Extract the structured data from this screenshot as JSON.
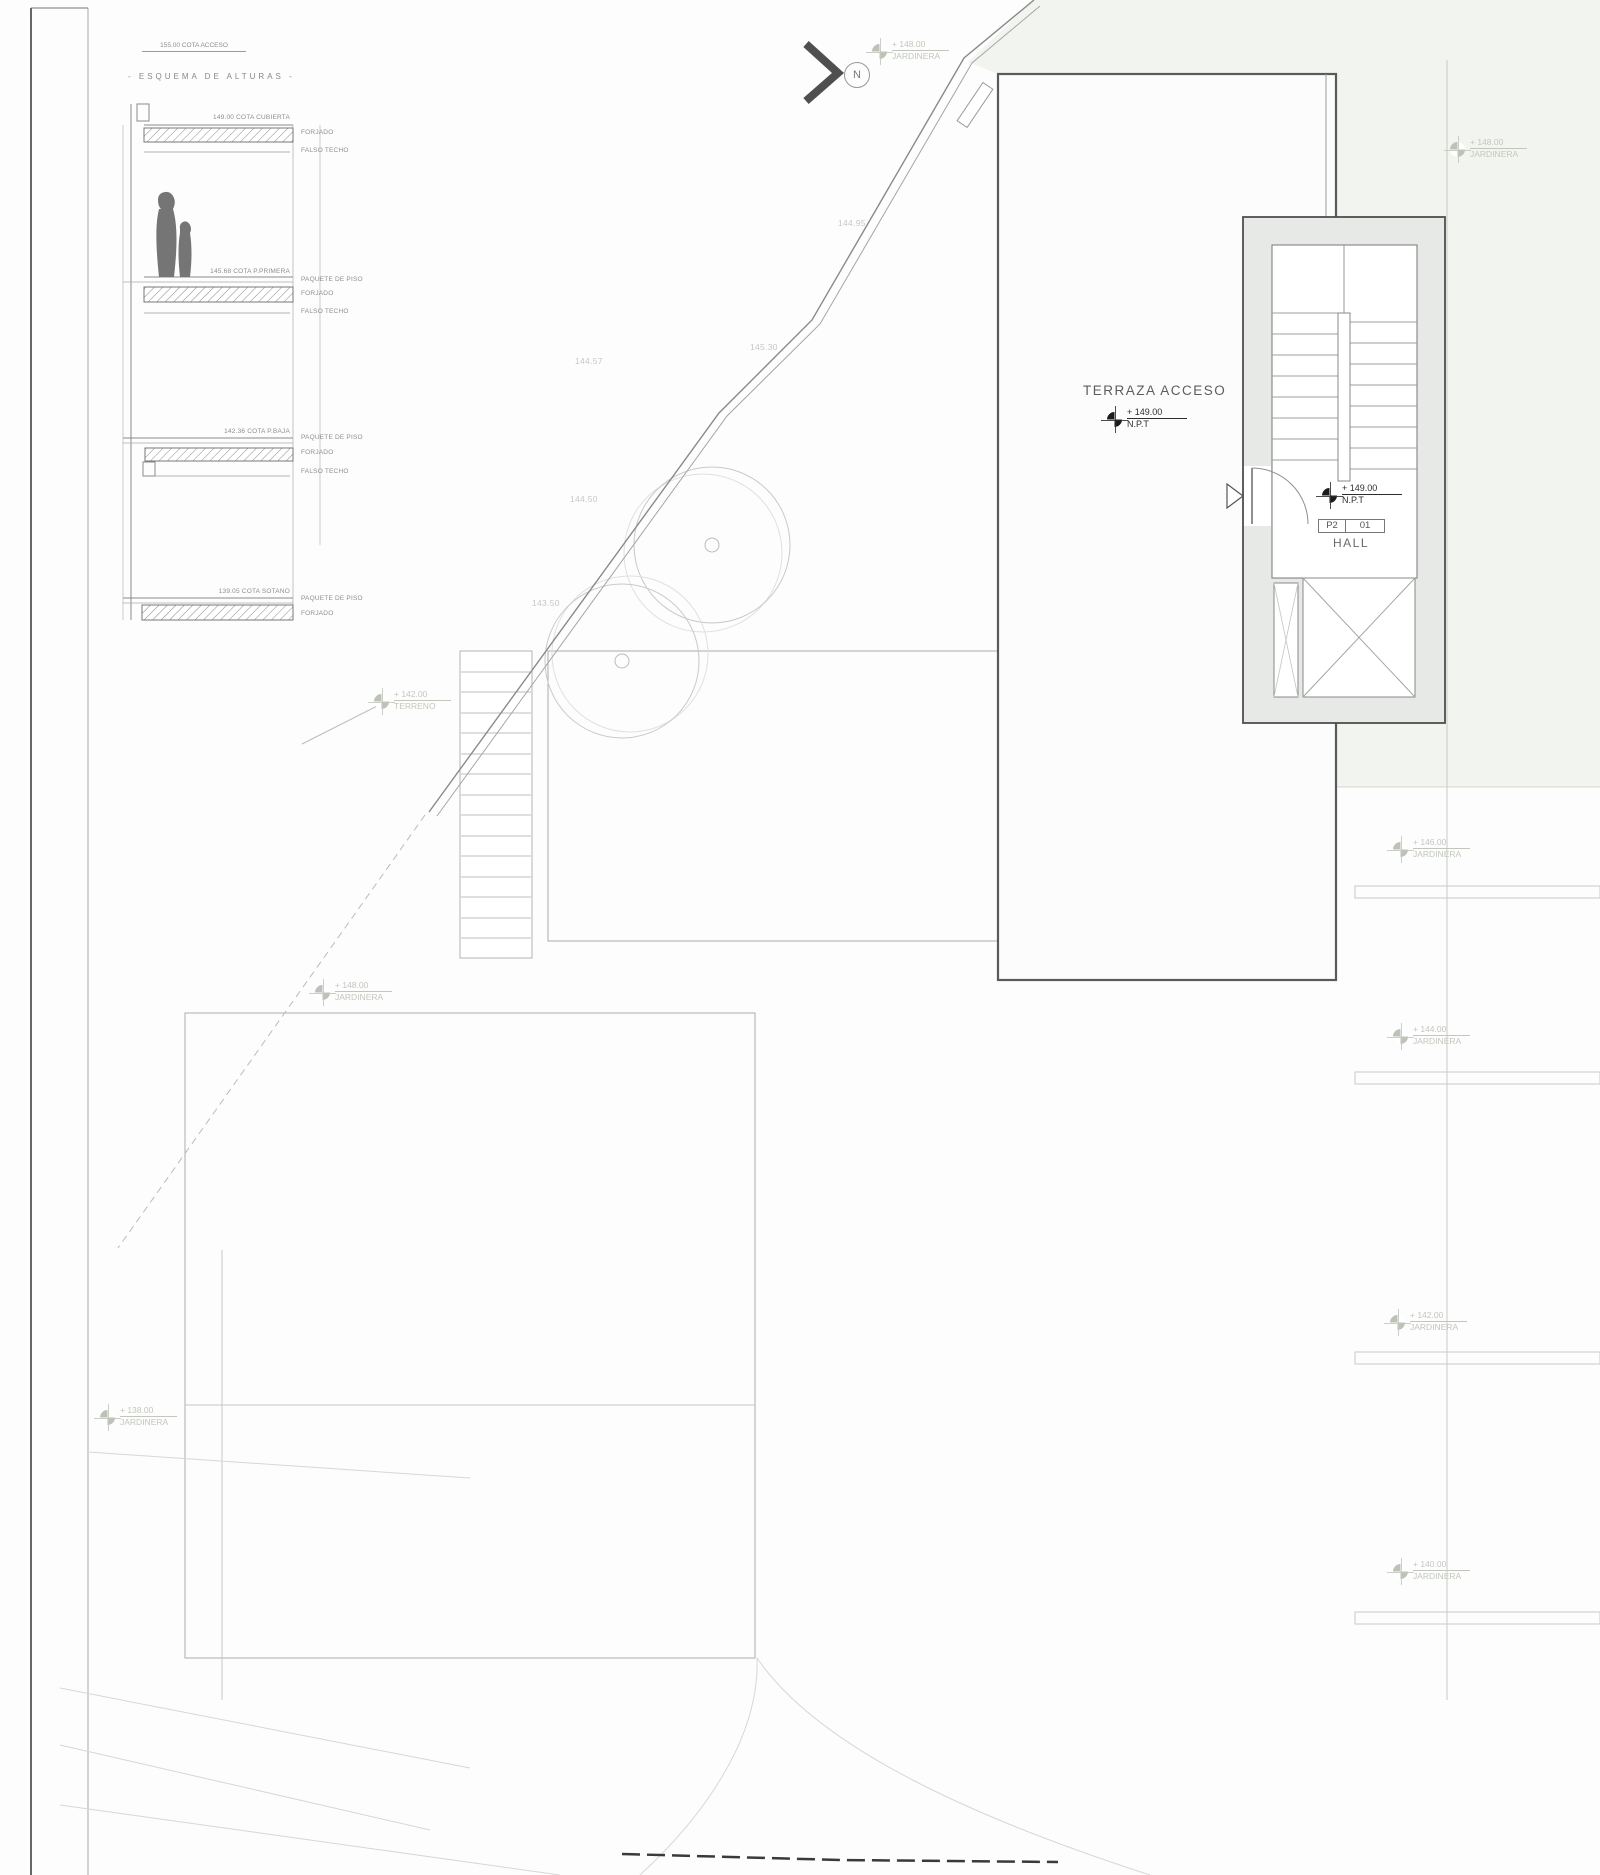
{
  "north": {
    "label": "N"
  },
  "scheme": {
    "access": "155.00 COTA ACCESO",
    "title": "- ESQUEMA DE ALTURAS -",
    "cubierta": "149.00 COTA CUBIERTA",
    "primera": "145.68 COTA P.PRIMERA",
    "baja": "142.36 COTA P.BAJA",
    "sotano": "139.05 COTA SOTANO",
    "forjado": "FORJADO",
    "falso_techo": "FALSO TECHO",
    "paquete": "PAQUETE DE PISO"
  },
  "plan": {
    "terraza": "TERRAZA ACCESO",
    "npt_value": "+ 149.00",
    "npt_sub": "N.P.T",
    "room_tag_left": "P2",
    "room_tag_right": "01",
    "room_name": "HALL"
  },
  "site": {
    "contours": [
      {
        "value": "144.95"
      },
      {
        "value": "145.30"
      },
      {
        "value": "144.57"
      },
      {
        "value": "144.50"
      },
      {
        "value": "143.50"
      }
    ],
    "markers": [
      {
        "value": "+ 148.00",
        "label": "JARDINERA"
      },
      {
        "value": "+ 148.00",
        "label": "JARDINERA"
      },
      {
        "value": "+ 148.00",
        "label": "JARDINERA"
      },
      {
        "value": "+ 142.00",
        "label": "TERRENO"
      },
      {
        "value": "+ 146.00",
        "label": "JARDINERA"
      },
      {
        "value": "+ 144.00",
        "label": "JARDINERA"
      },
      {
        "value": "+ 142.00",
        "label": "JARDINERA"
      },
      {
        "value": "+ 140.00",
        "label": "JARDINERA"
      },
      {
        "value": "+ 138.00",
        "label": "JARDINERA"
      }
    ]
  },
  "colors": {
    "tint": "#f2f4f0",
    "core_wall": "#e7e9e6",
    "dark_line": "#4e4e4e",
    "light_label": "#c2c7bd"
  }
}
